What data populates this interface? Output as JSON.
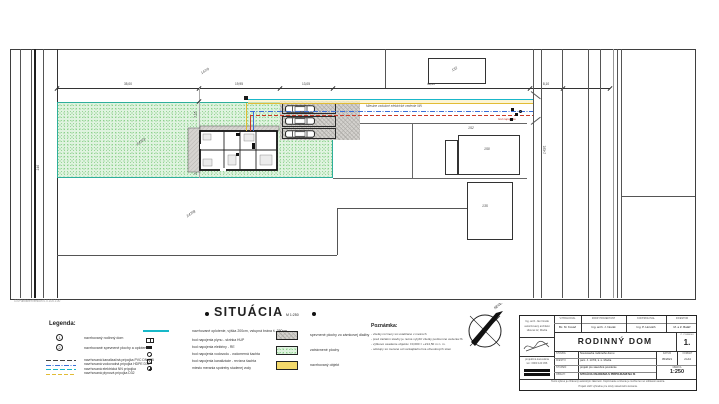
{
  "colors": {
    "fence_teal": "#17b8c8",
    "grass_green": "#dff3df",
    "utility_red": "#cc3a28",
    "utility_blue": "#3a6fd8",
    "utility_yellow": "#e2bc35",
    "paving_gray": "#d4d2ce",
    "swatch_yellow": "#f3d96b"
  },
  "plan": {
    "watermark": "GSPublisherVersion 0.0.100.100",
    "utility_label": "Miestne vzdušné elektrické vedenie NN",
    "connection_label": "bod napojenia",
    "parcel_green": "147/3",
    "parcel_south": "147/8",
    "parcel_north": "147/9",
    "parcel_road_left": "146",
    "parcel_road_right": "143/1",
    "building_north": "132",
    "building_east_a": "152",
    "building_east_b": "150",
    "building_south": "135",
    "dims_top": [
      "35,00",
      "19,95",
      "13,05",
      "48,50",
      "8,10"
    ],
    "dims_left": [
      "7,15",
      "9,60",
      "2,00"
    ]
  },
  "heading": {
    "title": "SITUÁCIA",
    "scale": "M 1:250"
  },
  "legend": {
    "heading": "Legenda:",
    "numbered": [
      {
        "num": "1",
        "label": "navrhovaný rodinný dom"
      },
      {
        "num": "2",
        "label": "navrhované spevnené plochy a oplotenie"
      }
    ],
    "lines": [
      {
        "label": "navrhovaná kanalizačná prípojka PVC DN 125"
      },
      {
        "label": "navrhovaná vodovodná prípojka HDPE D32"
      },
      {
        "label": "navrhovaná elektrická NN prípojka"
      },
      {
        "label": "navrhovaná plynová prípojka D32"
      }
    ],
    "fence_label": "navrhované oplotenie, výška 200cm, vstupná brána š. 350cm",
    "symbols": [
      {
        "label": "bod napojenia plynu - skrinka HUP"
      },
      {
        "label": "bod napojenia elektriny - RE"
      },
      {
        "label": "bod napojenia vodovodu - vodomerná šachta"
      },
      {
        "label": "bod napojenia kanalizácie - revízna šachta"
      },
      {
        "label": "miesto merania spotreby studenej vody"
      }
    ],
    "areas": [
      {
        "label": "spevnené plochy zo zámkovej dlažby"
      },
      {
        "label": "zatrávnené plochy"
      },
      {
        "label": "navrhovaný objekt"
      }
    ]
  },
  "notes": {
    "heading": "Poznámka:",
    "lines": [
      "- všetky rozmery sú uvádzané v metroch",
      "- pred začatím stavby je nutné vytýčiť všetky podzemné vedenia IS",
      "- výškové osadenie objektu: ±0,000 = +214,50 m n. m.",
      "- odstupy sú merané od vonkajšieho líca obvodových stien"
    ]
  },
  "north": {
    "label": "SEVER"
  },
  "titleblock": {
    "office1": [
      "Ing. arch. Ján Novák",
      "autorizovaný architekt",
      "Hlavná 12, Modra"
    ],
    "office2": [
      "projekčná kancelária",
      "tel.: 0900 123 456"
    ],
    "header_cols": [
      {
        "label": "VYPRACOVAL",
        "value": "Bc. M. Kováč"
      },
      {
        "label": "ZODP. PROJEKTANT",
        "value": "Ing. arch. J. Novák"
      },
      {
        "label": "KONTROLOVAL",
        "value": "Ing. P. Horváth"
      },
      {
        "label": "INVESTOR",
        "value": "M. a Z. Baláž"
      }
    ],
    "project_title": "RODINNÝ DOM",
    "number_label": "Č. VÝKRESU",
    "number": "1.",
    "rows": [
      {
        "label": "STAVBA:",
        "value": "Novostavba rodinného domu"
      },
      {
        "label": "MIESTO:",
        "value": "parc. č. 147/3, k. ú. Modra"
      },
      {
        "label": "STUPEŇ:",
        "value": "projekt pre stavebné povolenie"
      },
      {
        "label": "OBSAH:",
        "value": "SITUÁCIA OSADENIA S PRÍPOJKAMI NA IS"
      }
    ],
    "date_label": "DÁTUM",
    "date_value": "05/2021",
    "format_label": "FORMÁT",
    "format_value": "2×A4",
    "scale_label": "MIERKA",
    "scale_value": "1:250",
    "footer": [
      "Tento výkres je chránený autorským zákonom. Kopírovanie a šírenie je možné len so súhlasom autora.",
      "Projekt slúži výhradne pre účely stavebného konania."
    ]
  }
}
